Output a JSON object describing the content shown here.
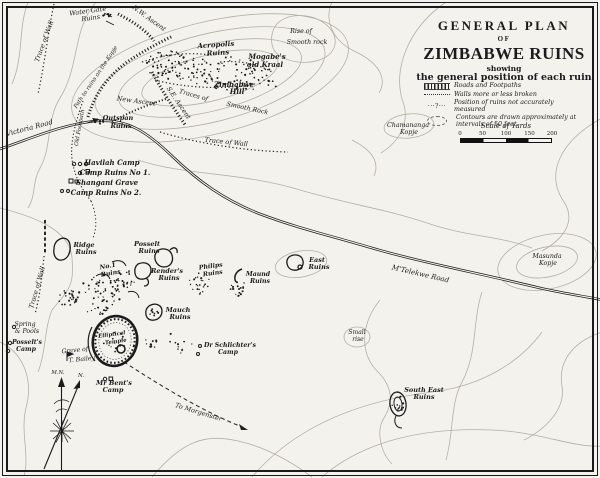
{
  "colors": {
    "paper": "#f3f2ec",
    "ink": "#1b1b1b",
    "contour": "#b3b0a6",
    "road": "#1c1c1c"
  },
  "title": {
    "line1": "GENERAL PLAN",
    "line2": "OF",
    "line3": "ZIMBABWE RUINS",
    "line4": "showing",
    "line5": "the general position of each ruin"
  },
  "legend": {
    "items": [
      {
        "symbol": "road-stripes-icon",
        "label": "Roads and Footpaths"
      },
      {
        "symbol": "dotted-line-icon",
        "label": "Walls more or less broken"
      },
      {
        "symbol": "ruin-dots-icon",
        "glyph": "···?···",
        "label": "Position of ruins not accurately measured"
      },
      {
        "symbol": "contour-oval-icon",
        "label": "Contours are drawn approximately at intervals of 50 feet."
      }
    ],
    "scale_title": "Scale of Yards",
    "scale_ticks": [
      "0",
      "50",
      "100",
      "150",
      "200"
    ]
  },
  "map_labels": [
    {
      "t": "Water Gate",
      "x": 88,
      "y": 13,
      "r": -8,
      "s": 6.5
    },
    {
      "t": "Ruins",
      "x": 91,
      "y": 20,
      "r": -8,
      "s": 6.5
    },
    {
      "t": "N.W. Ascent",
      "x": 148,
      "y": 20,
      "r": 36,
      "s": 6.5
    },
    {
      "t": "Trace of Wall",
      "x": 46,
      "y": 42,
      "r": -70,
      "s": 6.5
    },
    {
      "t": "Path to ruins on the Kopje",
      "x": 97,
      "y": 78,
      "r": -56,
      "s": 5.6
    },
    {
      "t": "Acropolis",
      "x": 216,
      "y": 47,
      "r": -4,
      "s": 7,
      "b": 1
    },
    {
      "t": "Ruins",
      "x": 218,
      "y": 55,
      "r": -4,
      "s": 7,
      "b": 1
    },
    {
      "t": "Mogabe's",
      "x": 267,
      "y": 59,
      "r": 0,
      "s": 7,
      "b": 1
    },
    {
      "t": "old Kraal",
      "x": 265,
      "y": 67,
      "r": 0,
      "s": 7,
      "b": 1
    },
    {
      "t": "Rise of",
      "x": 301,
      "y": 33,
      "r": 0,
      "s": 6.3
    },
    {
      "t": "Smooth rock",
      "x": 307,
      "y": 44,
      "r": 0,
      "s": 6.3
    },
    {
      "t": "Zimbabwe",
      "x": 234,
      "y": 87,
      "r": 0,
      "s": 7,
      "b": 1
    },
    {
      "t": "Hill",
      "x": 237,
      "y": 94,
      "r": 0,
      "s": 7,
      "b": 1
    },
    {
      "t": "Traces of",
      "x": 193,
      "y": 97,
      "r": 16,
      "s": 6.3
    },
    {
      "t": "Smooth Rock",
      "x": 247,
      "y": 110,
      "r": 12,
      "s": 6.3
    },
    {
      "t": "S.E. Ascent",
      "x": 177,
      "y": 104,
      "r": 56,
      "s": 6.5
    },
    {
      "t": "New Ascent",
      "x": 136,
      "y": 103,
      "r": 8,
      "s": 6.5
    },
    {
      "t": "Trace of Wall",
      "x": 226,
      "y": 144,
      "r": 6,
      "s": 6.5
    },
    {
      "t": "Outspan",
      "x": 118,
      "y": 120,
      "r": 0,
      "s": 6.5,
      "b": 1
    },
    {
      "t": "Ruins",
      "x": 121,
      "y": 128,
      "r": 0,
      "s": 6.5,
      "b": 1
    },
    {
      "t": "Victoria Road",
      "x": 30,
      "y": 130,
      "r": -15,
      "s": 7
    },
    {
      "t": "Old Footpath",
      "x": 81,
      "y": 128,
      "r": -80,
      "s": 5.6
    },
    {
      "t": "Havilah Camp",
      "x": 112,
      "y": 165,
      "r": 0,
      "s": 7,
      "b": 1
    },
    {
      "t": "Camp Ruins No 1.",
      "x": 115,
      "y": 175,
      "r": 0,
      "s": 7,
      "b": 1
    },
    {
      "t": "Shangani Grave",
      "x": 107,
      "y": 185,
      "r": 0,
      "s": 7,
      "b": 1
    },
    {
      "t": "Camp Ruins No 2.",
      "x": 106,
      "y": 195,
      "r": 0,
      "s": 7,
      "b": 1
    },
    {
      "t": "Chamananga",
      "x": 408,
      "y": 127,
      "r": 0,
      "s": 6.3
    },
    {
      "t": "Kopje",
      "x": 409,
      "y": 134,
      "r": 0,
      "s": 6.3
    },
    {
      "t": "Ridge",
      "x": 84,
      "y": 247,
      "r": 0,
      "s": 6.5,
      "b": 1
    },
    {
      "t": "Ruins",
      "x": 86,
      "y": 254,
      "r": 0,
      "s": 6.5,
      "b": 1
    },
    {
      "t": "Posselt",
      "x": 147,
      "y": 246,
      "r": 0,
      "s": 6.5,
      "b": 1
    },
    {
      "t": "Ruins",
      "x": 149,
      "y": 253,
      "r": 0,
      "s": 6.5,
      "b": 1
    },
    {
      "t": "No.1",
      "x": 108,
      "y": 268,
      "r": -10,
      "s": 6.2,
      "b": 1
    },
    {
      "t": "Ruins",
      "x": 111,
      "y": 275,
      "r": -10,
      "s": 6.2,
      "b": 1
    },
    {
      "t": "Render's",
      "x": 167,
      "y": 273,
      "r": 0,
      "s": 6.5,
      "b": 1
    },
    {
      "t": "Ruins",
      "x": 169,
      "y": 280,
      "r": 0,
      "s": 6.5,
      "b": 1
    },
    {
      "t": "Philips",
      "x": 211,
      "y": 268,
      "r": -8,
      "s": 6.2,
      "b": 1
    },
    {
      "t": "Ruins",
      "x": 213,
      "y": 275,
      "r": -8,
      "s": 6.2,
      "b": 1
    },
    {
      "t": "Maund",
      "x": 258,
      "y": 276,
      "r": 0,
      "s": 6.2,
      "b": 1
    },
    {
      "t": "Ruins",
      "x": 260,
      "y": 283,
      "r": 0,
      "s": 6.2,
      "b": 1
    },
    {
      "t": "East",
      "x": 317,
      "y": 262,
      "r": 0,
      "s": 6.5,
      "b": 1
    },
    {
      "t": "Ruins",
      "x": 319,
      "y": 269,
      "r": 0,
      "s": 6.5,
      "b": 1
    },
    {
      "t": "M'Telekwe Road",
      "x": 420,
      "y": 276,
      "r": 13,
      "s": 7
    },
    {
      "t": "Masunda",
      "x": 547,
      "y": 258,
      "r": 0,
      "s": 6.3
    },
    {
      "t": "Kopje",
      "x": 548,
      "y": 265,
      "r": 0,
      "s": 6.3
    },
    {
      "t": "Trace of Wall",
      "x": 39,
      "y": 288,
      "r": -74,
      "s": 6.5
    },
    {
      "t": "Mauch",
      "x": 178,
      "y": 312,
      "r": 0,
      "s": 6.5,
      "b": 1
    },
    {
      "t": "Ruins",
      "x": 180,
      "y": 319,
      "r": 0,
      "s": 6.5,
      "b": 1
    },
    {
      "t": "Spring",
      "x": 25,
      "y": 326,
      "r": 0,
      "s": 6.2
    },
    {
      "t": "& Pools",
      "x": 27,
      "y": 333,
      "r": 0,
      "s": 6.2
    },
    {
      "t": "Posselt's",
      "x": 27,
      "y": 344,
      "r": 0,
      "s": 6.2,
      "b": 1
    },
    {
      "t": "Camp",
      "x": 26,
      "y": 351,
      "r": 0,
      "s": 6.2,
      "b": 1
    },
    {
      "t": "Elliptical",
      "x": 112,
      "y": 336,
      "r": -8,
      "s": 5.4,
      "b": 1
    },
    {
      "t": "Temple",
      "x": 116,
      "y": 343,
      "r": -8,
      "s": 5.4,
      "b": 1
    },
    {
      "t": "Grave of",
      "x": 75,
      "y": 352,
      "r": -6,
      "s": 6.2
    },
    {
      "t": "T. Bailey",
      "x": 82,
      "y": 361,
      "r": -6,
      "s": 6.2
    },
    {
      "t": "Dr Schlichter's",
      "x": 230,
      "y": 347,
      "r": 0,
      "s": 6.2,
      "b": 1
    },
    {
      "t": "Camp",
      "x": 228,
      "y": 354,
      "r": 0,
      "s": 6.2,
      "b": 1
    },
    {
      "t": "Mr Bent's",
      "x": 114,
      "y": 385,
      "r": 0,
      "s": 6.5,
      "b": 1
    },
    {
      "t": "Camp",
      "x": 113,
      "y": 392,
      "r": 0,
      "s": 6.5,
      "b": 1
    },
    {
      "t": "M.N.",
      "x": 58,
      "y": 374,
      "r": 0,
      "s": 5.4
    },
    {
      "t": "N.",
      "x": 81,
      "y": 377,
      "r": 0,
      "s": 5.4
    },
    {
      "t": "To Morgenster",
      "x": 198,
      "y": 414,
      "r": 17,
      "s": 6.5
    },
    {
      "t": "Small",
      "x": 357,
      "y": 334,
      "r": 0,
      "s": 6
    },
    {
      "t": "rise",
      "x": 358,
      "y": 341,
      "r": 0,
      "s": 6
    },
    {
      "t": "South East",
      "x": 424,
      "y": 392,
      "r": 0,
      "s": 6.5,
      "b": 1
    },
    {
      "t": "Ruins",
      "x": 424,
      "y": 399,
      "r": 0,
      "s": 6.5,
      "b": 1
    }
  ]
}
